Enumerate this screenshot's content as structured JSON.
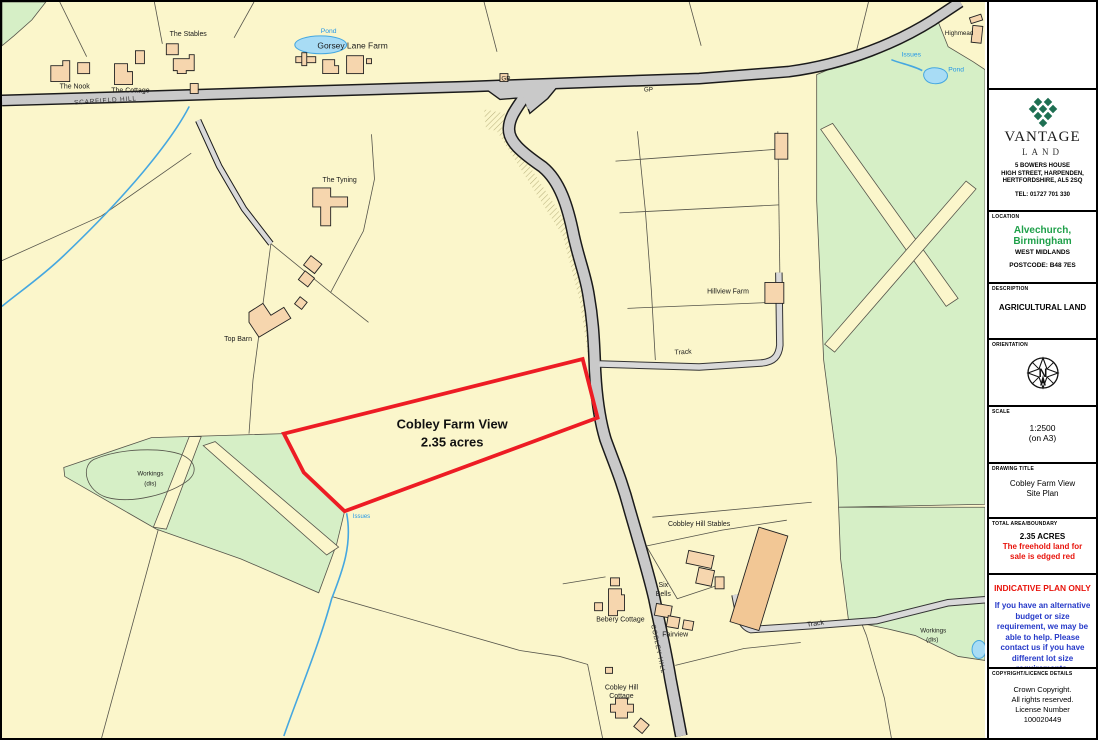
{
  "window": {
    "type": "land-sale-site-plan"
  },
  "colors": {
    "plot_boundary": "#ED1C24",
    "field": "#FBF6CB",
    "woodland": "#D6EFC6",
    "water_fill": "#A8DCF5",
    "water_line": "#45A7E0",
    "road": "#C9C9C9",
    "building": "#F6D6AE",
    "building_large": "#F2C795",
    "brand_green": "#1E6F52",
    "location_green": "#1FA04A",
    "warning_red": "#E8140C",
    "info_blue": "#2438C8"
  },
  "map": {
    "plot": {
      "name": "Cobley Farm View",
      "area": "2.35 acres"
    },
    "labels": {
      "scarfield_hill": "SCARFIELD HILL",
      "cobley_hill": "COBLEY HILL",
      "gp_west": "GP",
      "gp_east": "GP",
      "the_nook": "The Nook",
      "the_cottage": "The Cottage",
      "the_stables": "The Stables",
      "pond_nw": "Pond",
      "gorsey_lane_farm": "Gorsey Lane Farm",
      "highmead": "Highmead",
      "issues_ne": "Issues",
      "pond_ne": "Pond",
      "the_tyning": "The Tyning",
      "top_barn": "Top Barn",
      "hillview_farm": "Hillview Farm",
      "track_mid": "Track",
      "track_south": "Track",
      "workings_west_1": "Workings",
      "workings_west_2": "(dis)",
      "issues_mid": "Issues",
      "cobbley_hill_stables": "Cobbley Hill Stables",
      "six": "Six",
      "bells": "Bells",
      "bebery_cottage": "Bebery Cottage",
      "fairview": "Fairview",
      "cobley_hill_cottage_1": "Cobley Hill",
      "cobley_hill_cottage_2": "Cottage",
      "workings_se_1": "Workings",
      "workings_se_2": "(dis)"
    }
  },
  "sidebar": {
    "brand": {
      "name": "VANTAGE",
      "sub": "LAND",
      "address_lines": [
        "5 BOWERS HOUSE",
        "HIGH STREET, HARPENDEN,",
        "HERTFORDSHIRE, AL5 2SQ"
      ],
      "tel": "TEL: 01727 701 330"
    },
    "location": {
      "label": "LOCATION",
      "line1": "Alvechurch,",
      "line2": "Birmingham",
      "region": "WEST MIDLANDS",
      "postcode": "POSTCODE: B48 7ES"
    },
    "description": {
      "label": "DESCRIPTION",
      "value": "AGRICULTURAL LAND"
    },
    "orientation": {
      "label": "ORIENTATION",
      "north": "N"
    },
    "scale": {
      "label": "SCALE",
      "ratio": "1:2500",
      "paper": "(on A3)"
    },
    "title": {
      "label": "DRAWING TITLE",
      "line1": "Cobley Farm View",
      "line2": "Site Plan"
    },
    "area": {
      "label": "TOTAL AREA/BOUNDARY",
      "acres": "2.35 ACRES",
      "note": "The freehold land for sale is edged red"
    },
    "indicative": {
      "heading": "INDICATIVE PLAN ONLY",
      "body": "If you have an alternative budget or size requirement, we may be able to help. Please contact us if you have different lot size requirements."
    },
    "copyright": {
      "label": "COPYRIGHT/LICENCE DETAILS",
      "lines": [
        "Crown Copyright.",
        "All rights reserved.",
        "License Number",
        "100020449"
      ]
    }
  }
}
